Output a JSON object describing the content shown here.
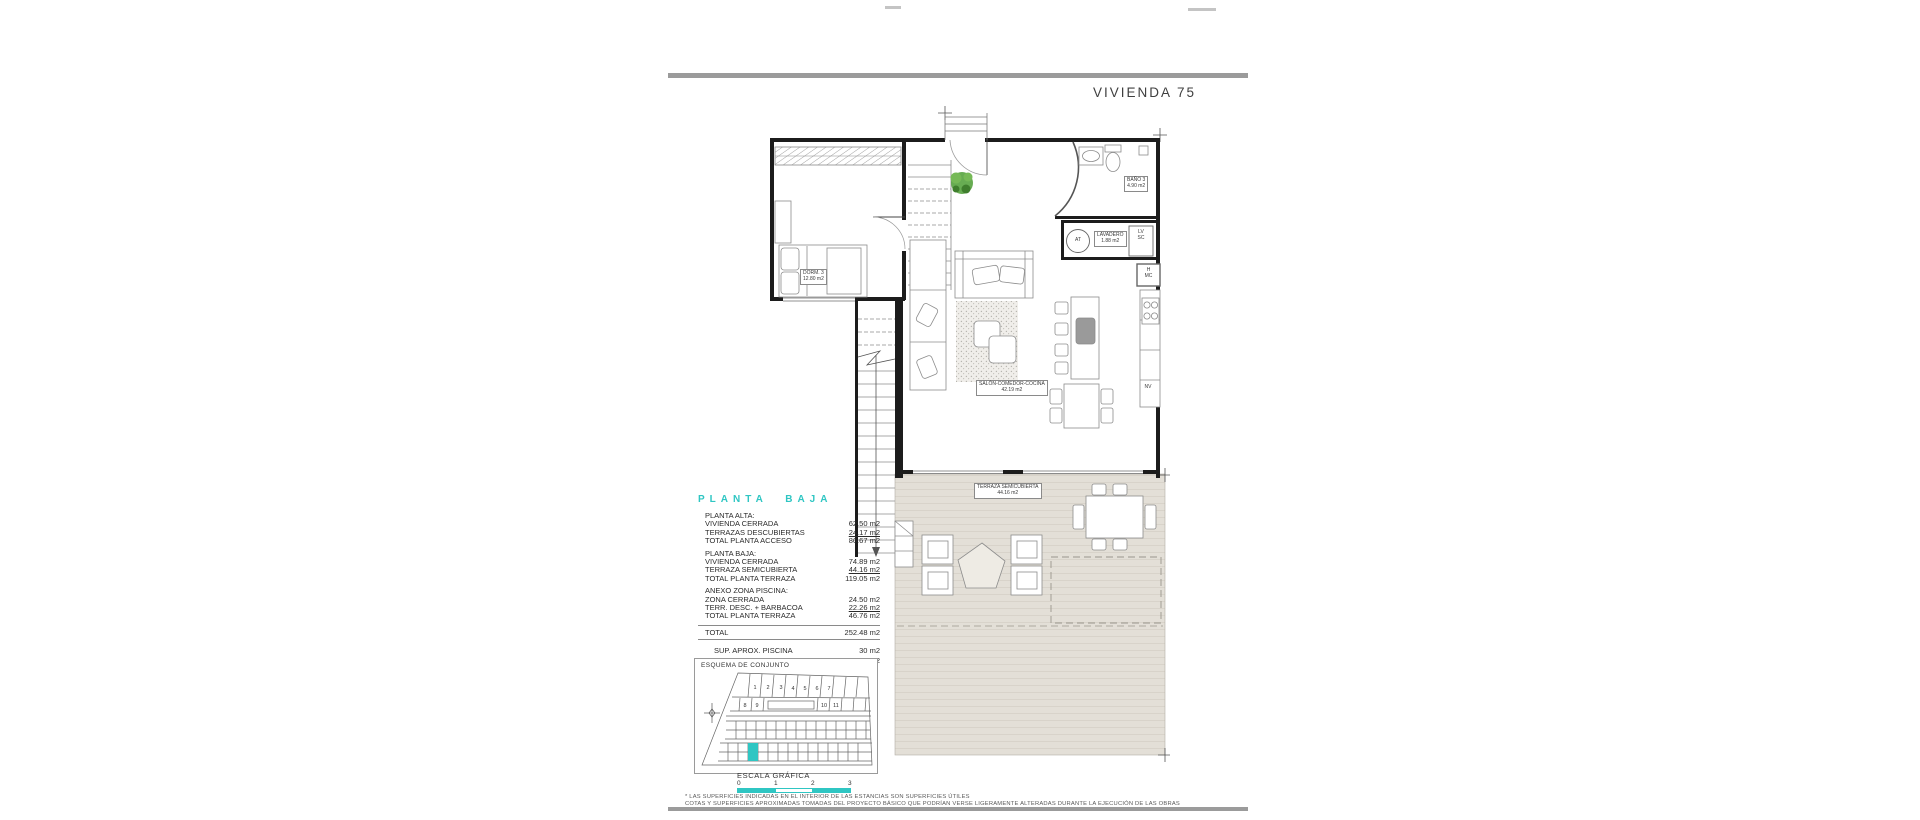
{
  "page": {
    "title": "VIVIENDA 75",
    "accent_color": "#2fc6c3",
    "bar_color": "#9b9b9b"
  },
  "plan": {
    "rooms": [
      {
        "name": "DORM. 3",
        "area": "12.80 m2"
      },
      {
        "name": "BAÑO 3",
        "area": "4.90 m2"
      },
      {
        "name": "LAVADERO",
        "area": "1.88 m2"
      },
      {
        "name": "SALÓN-COMEDOR-COCINA",
        "area": "42.19 m2"
      },
      {
        "name": "TERRAZA SEMICUBIERTA",
        "area": "44.16 m2"
      }
    ],
    "appliances": {
      "at": "AT",
      "lv": "LV",
      "sc": "SC",
      "h": "H",
      "mc": "MC",
      "nv": "NV"
    }
  },
  "summary": {
    "heading": "PLANTA BAJA",
    "sections": [
      {
        "title": "PLANTA ALTA:",
        "rows": [
          {
            "label": "VIVIENDA CERRADA",
            "value": "62.50 m2"
          },
          {
            "label": "TERRAZAS DESCUBIERTAS",
            "value": "24.17 m2"
          },
          {
            "label": "TOTAL PLANTA ACCESO",
            "value": "86.67 m2"
          }
        ]
      },
      {
        "title": "PLANTA BAJA:",
        "rows": [
          {
            "label": "VIVIENDA CERRADA",
            "value": "74.89 m2"
          },
          {
            "label": "TERRAZA SEMICUBIERTA",
            "value": "44.16 m2"
          },
          {
            "label": "TOTAL PLANTA TERRAZA",
            "value": "119.05 m2"
          }
        ]
      },
      {
        "title": "ANEXO ZONA PISCINA:",
        "rows": [
          {
            "label": "ZONA CERRADA",
            "value": "24.50 m2"
          },
          {
            "label": "TERR. DESC. + BARBACOA",
            "value": "22.26 m2"
          },
          {
            "label": "TOTAL PLANTA TERRAZA",
            "value": "46.76 m2"
          }
        ]
      }
    ],
    "total": {
      "label": "TOTAL",
      "value": "252.48 m2"
    },
    "extras": [
      {
        "label": "SUP. APROX. PISCINA",
        "value": "30 m2"
      },
      {
        "label": "SUP. APROX. PARCELA",
        "value": "400 m2"
      }
    ]
  },
  "site_plan": {
    "title": "ESQUEMA DE CONJUNTO",
    "plot_numbers": [
      "1",
      "2",
      "3",
      "4",
      "5",
      "6",
      "7",
      "8",
      "9",
      "10",
      "11"
    ]
  },
  "scale": {
    "title": "ESCALA GRÁFICA",
    "ticks": [
      "0",
      "1",
      "2",
      "3"
    ]
  },
  "footer": {
    "line1": "* LAS SUPERFICIES INDICADAS EN EL INTERIOR DE LAS ESTANCIAS SON SUPERFICIES ÚTILES",
    "line2": "COTAS Y SUPERFICIES APROXIMADAS TOMADAS DEL PROYECTO BÁSICO QUE PODRÍAN VERSE LIGERAMENTE ALTERADAS DURANTE LA EJECUCIÓN DE LAS OBRAS"
  }
}
